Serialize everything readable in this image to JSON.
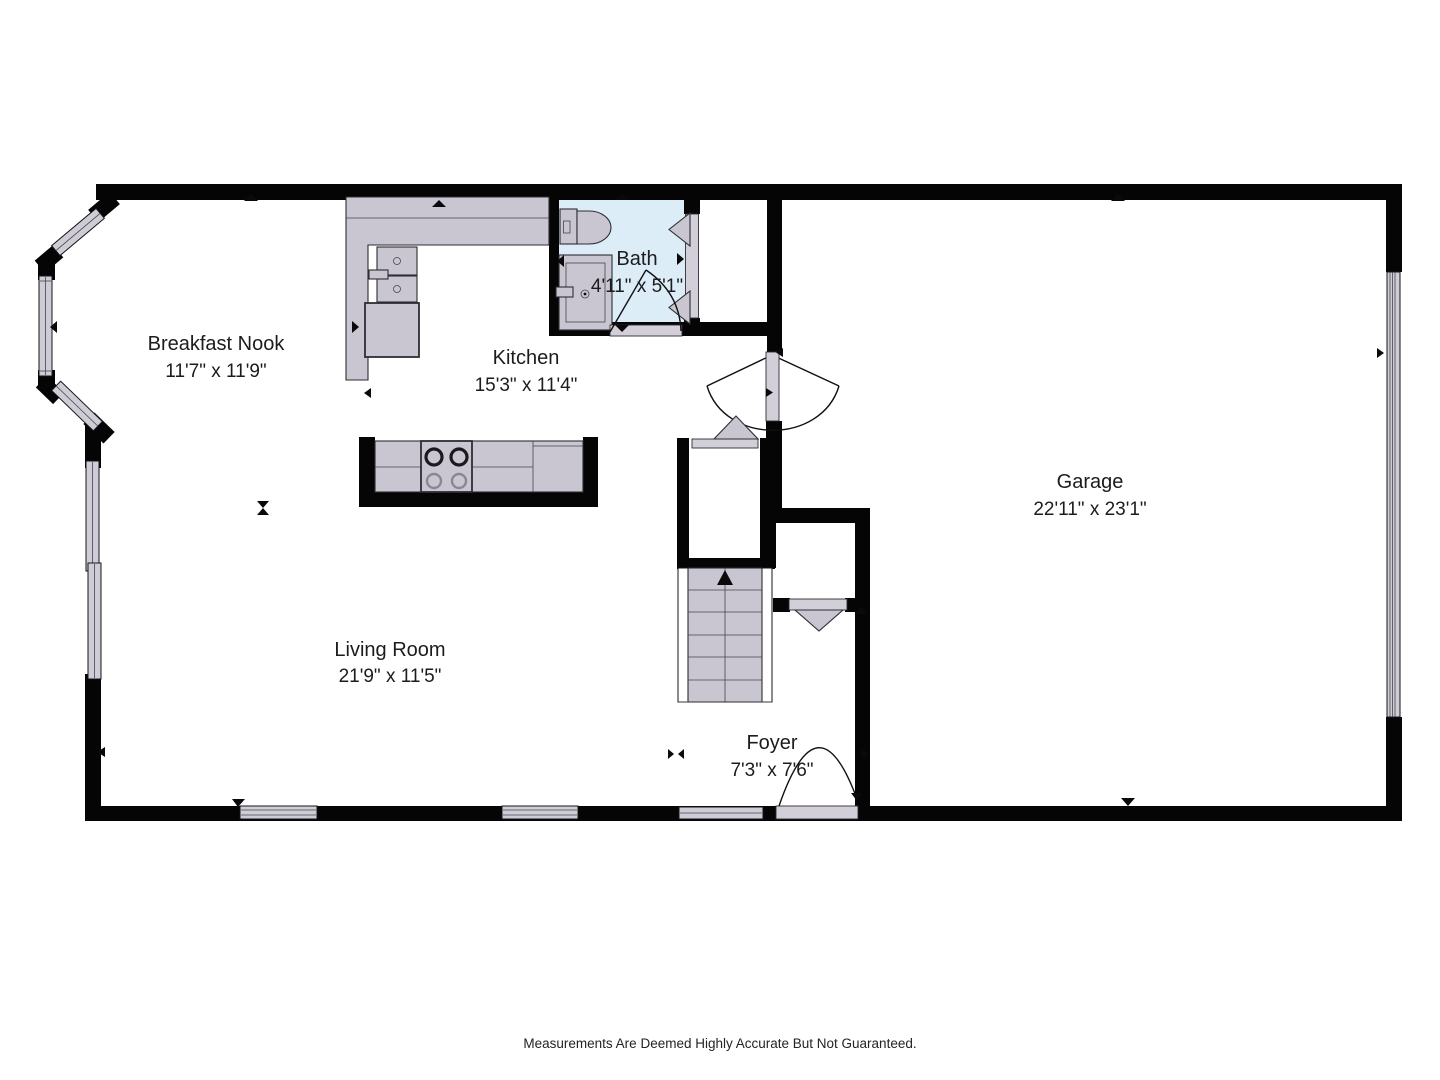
{
  "rooms": {
    "breakfast_nook": {
      "name": "Breakfast Nook",
      "dims": "11'7\" x 11'9\""
    },
    "kitchen": {
      "name": "Kitchen",
      "dims": "15'3\" x 11'4\""
    },
    "bath": {
      "name": "Bath",
      "dims": "4'11\" x 5'1\""
    },
    "garage": {
      "name": "Garage",
      "dims": "22'11\" x 23'1\""
    },
    "living_room": {
      "name": "Living Room",
      "dims": "21'9\" x 11'5\""
    },
    "foyer": {
      "name": "Foyer",
      "dims": "7'3\" x 7'6\""
    }
  },
  "footer": {
    "disclaimer": "Measurements Are Deemed Highly Accurate But Not Guaranteed."
  },
  "colors": {
    "wall": "#050505",
    "fixture_fill": "#c9c5d1",
    "bath_fill": "#ddedf8",
    "background": "#ffffff"
  }
}
